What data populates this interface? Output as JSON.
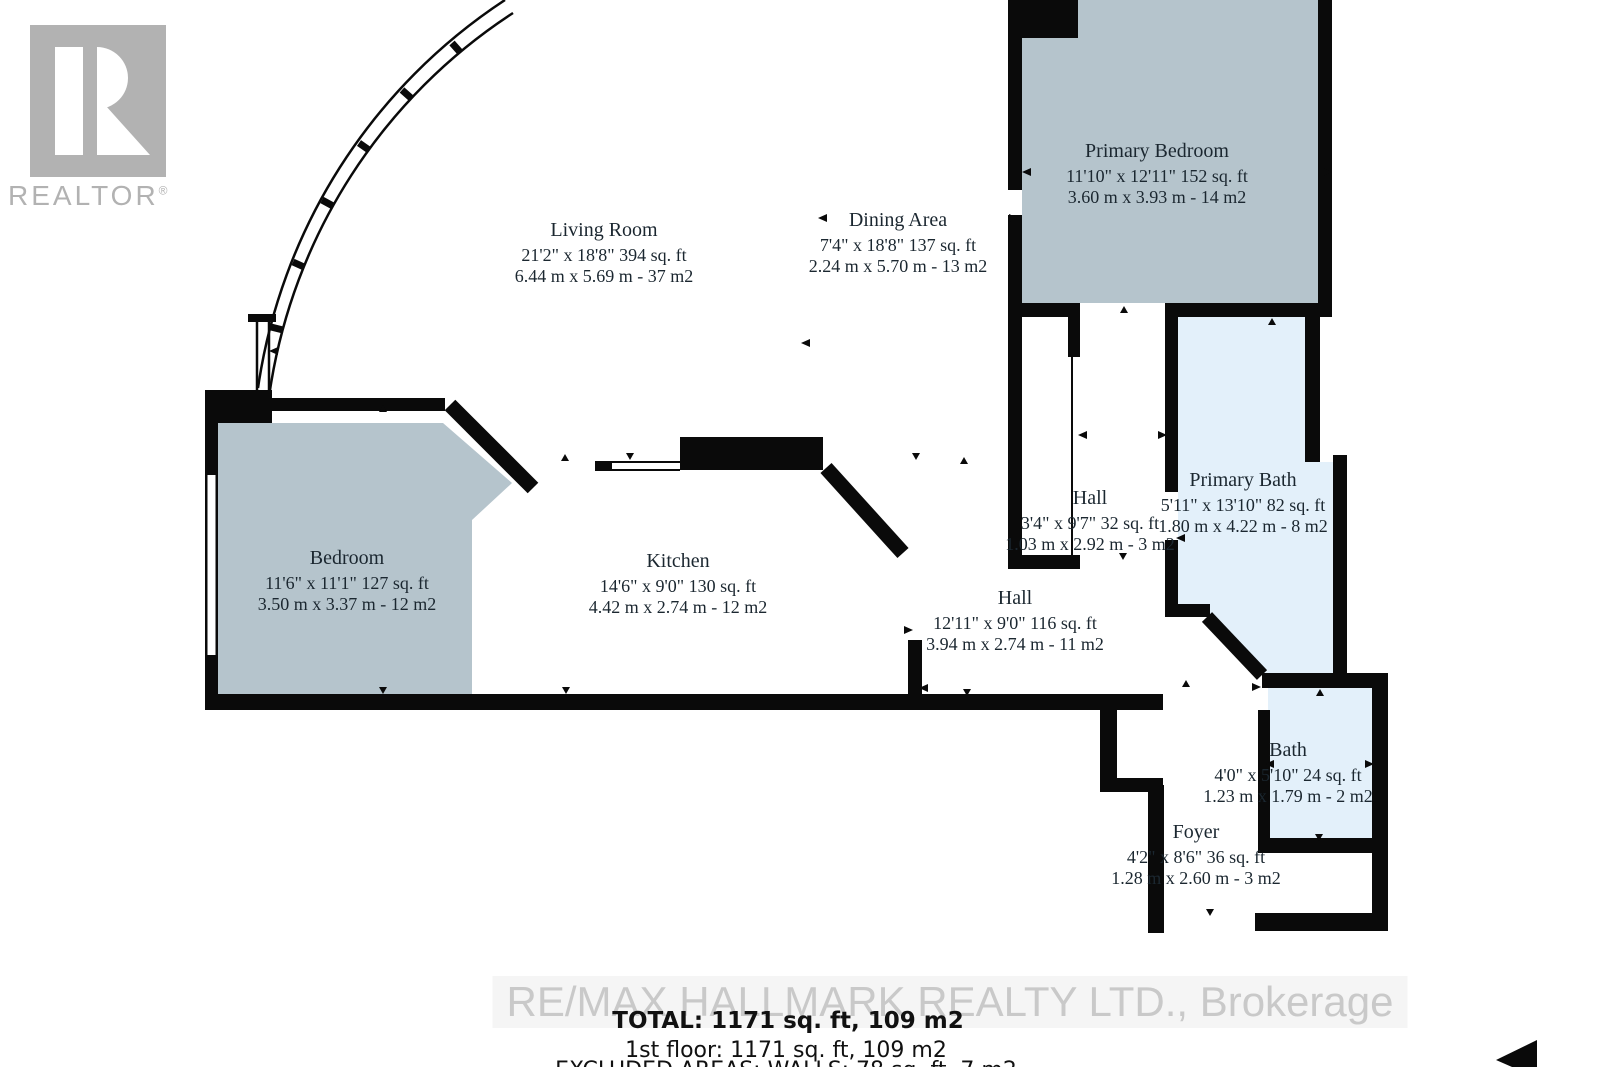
{
  "branding": {
    "realtor_logo_text": "REALTOR",
    "registered_mark": "®",
    "watermark": "RE/MAX HALLMARK REALTY LTD., Brokerage"
  },
  "rooms": [
    {
      "id": "living-room",
      "name": "Living Room",
      "imperial": "21'2\" x 18'8\" 394 sq. ft",
      "metric": "6.44 m x 5.69 m - 37 m2"
    },
    {
      "id": "dining-area",
      "name": "Dining Area",
      "imperial": "7'4\" x 18'8\" 137 sq. ft",
      "metric": "2.24 m x 5.70 m - 13 m2"
    },
    {
      "id": "primary-bedroom",
      "name": "Primary Bedroom",
      "imperial": "11'10\" x 12'11\" 152 sq. ft",
      "metric": "3.60 m x 3.93 m - 14 m2"
    },
    {
      "id": "bedroom",
      "name": "Bedroom",
      "imperial": "11'6\" x 11'1\" 127 sq. ft",
      "metric": "3.50 m x 3.37 m - 12 m2"
    },
    {
      "id": "kitchen",
      "name": "Kitchen",
      "imperial": "14'6\" x 9'0\" 130 sq. ft",
      "metric": "4.42 m x 2.74 m - 12 m2"
    },
    {
      "id": "hall-upper",
      "name": "Hall",
      "imperial": "3'4\" x 9'7\" 32 sq. ft",
      "metric": "1.03 m x 2.92 m - 3 m2"
    },
    {
      "id": "primary-bath",
      "name": "Primary Bath",
      "imperial": "5'11\" x 13'10\" 82 sq. ft",
      "metric": "1.80 m x 4.22 m - 8 m2"
    },
    {
      "id": "hall-main",
      "name": "Hall",
      "imperial": "12'11\" x 9'0\" 116 sq. ft",
      "metric": "3.94 m x 2.74 m - 11 m2"
    },
    {
      "id": "bath",
      "name": "Bath",
      "imperial": "4'0\" x 5'10\" 24 sq. ft",
      "metric": "1.23 m x 1.79 m - 2 m2"
    },
    {
      "id": "foyer",
      "name": "Foyer",
      "imperial": "4'2\" x 8'6\" 36 sq. ft",
      "metric": "1.28 m x 2.60 m - 3 m2"
    }
  ],
  "summary": {
    "total": "TOTAL: 1171 sq. ft, 109 m2",
    "first_floor": "1st floor: 1171 sq. ft, 109 m2",
    "excluded": "EXCLUDED AREAS: WALLS: 78 sq. ft, 7 m2"
  },
  "colors": {
    "wall": "#0a0a0a",
    "room_fill_gray_blue": "#b5c4cc",
    "room_fill_light_blue": "#e3f0fa",
    "logo_gray": "#b2b2b2",
    "watermark_gray": "#c9c9c9"
  }
}
